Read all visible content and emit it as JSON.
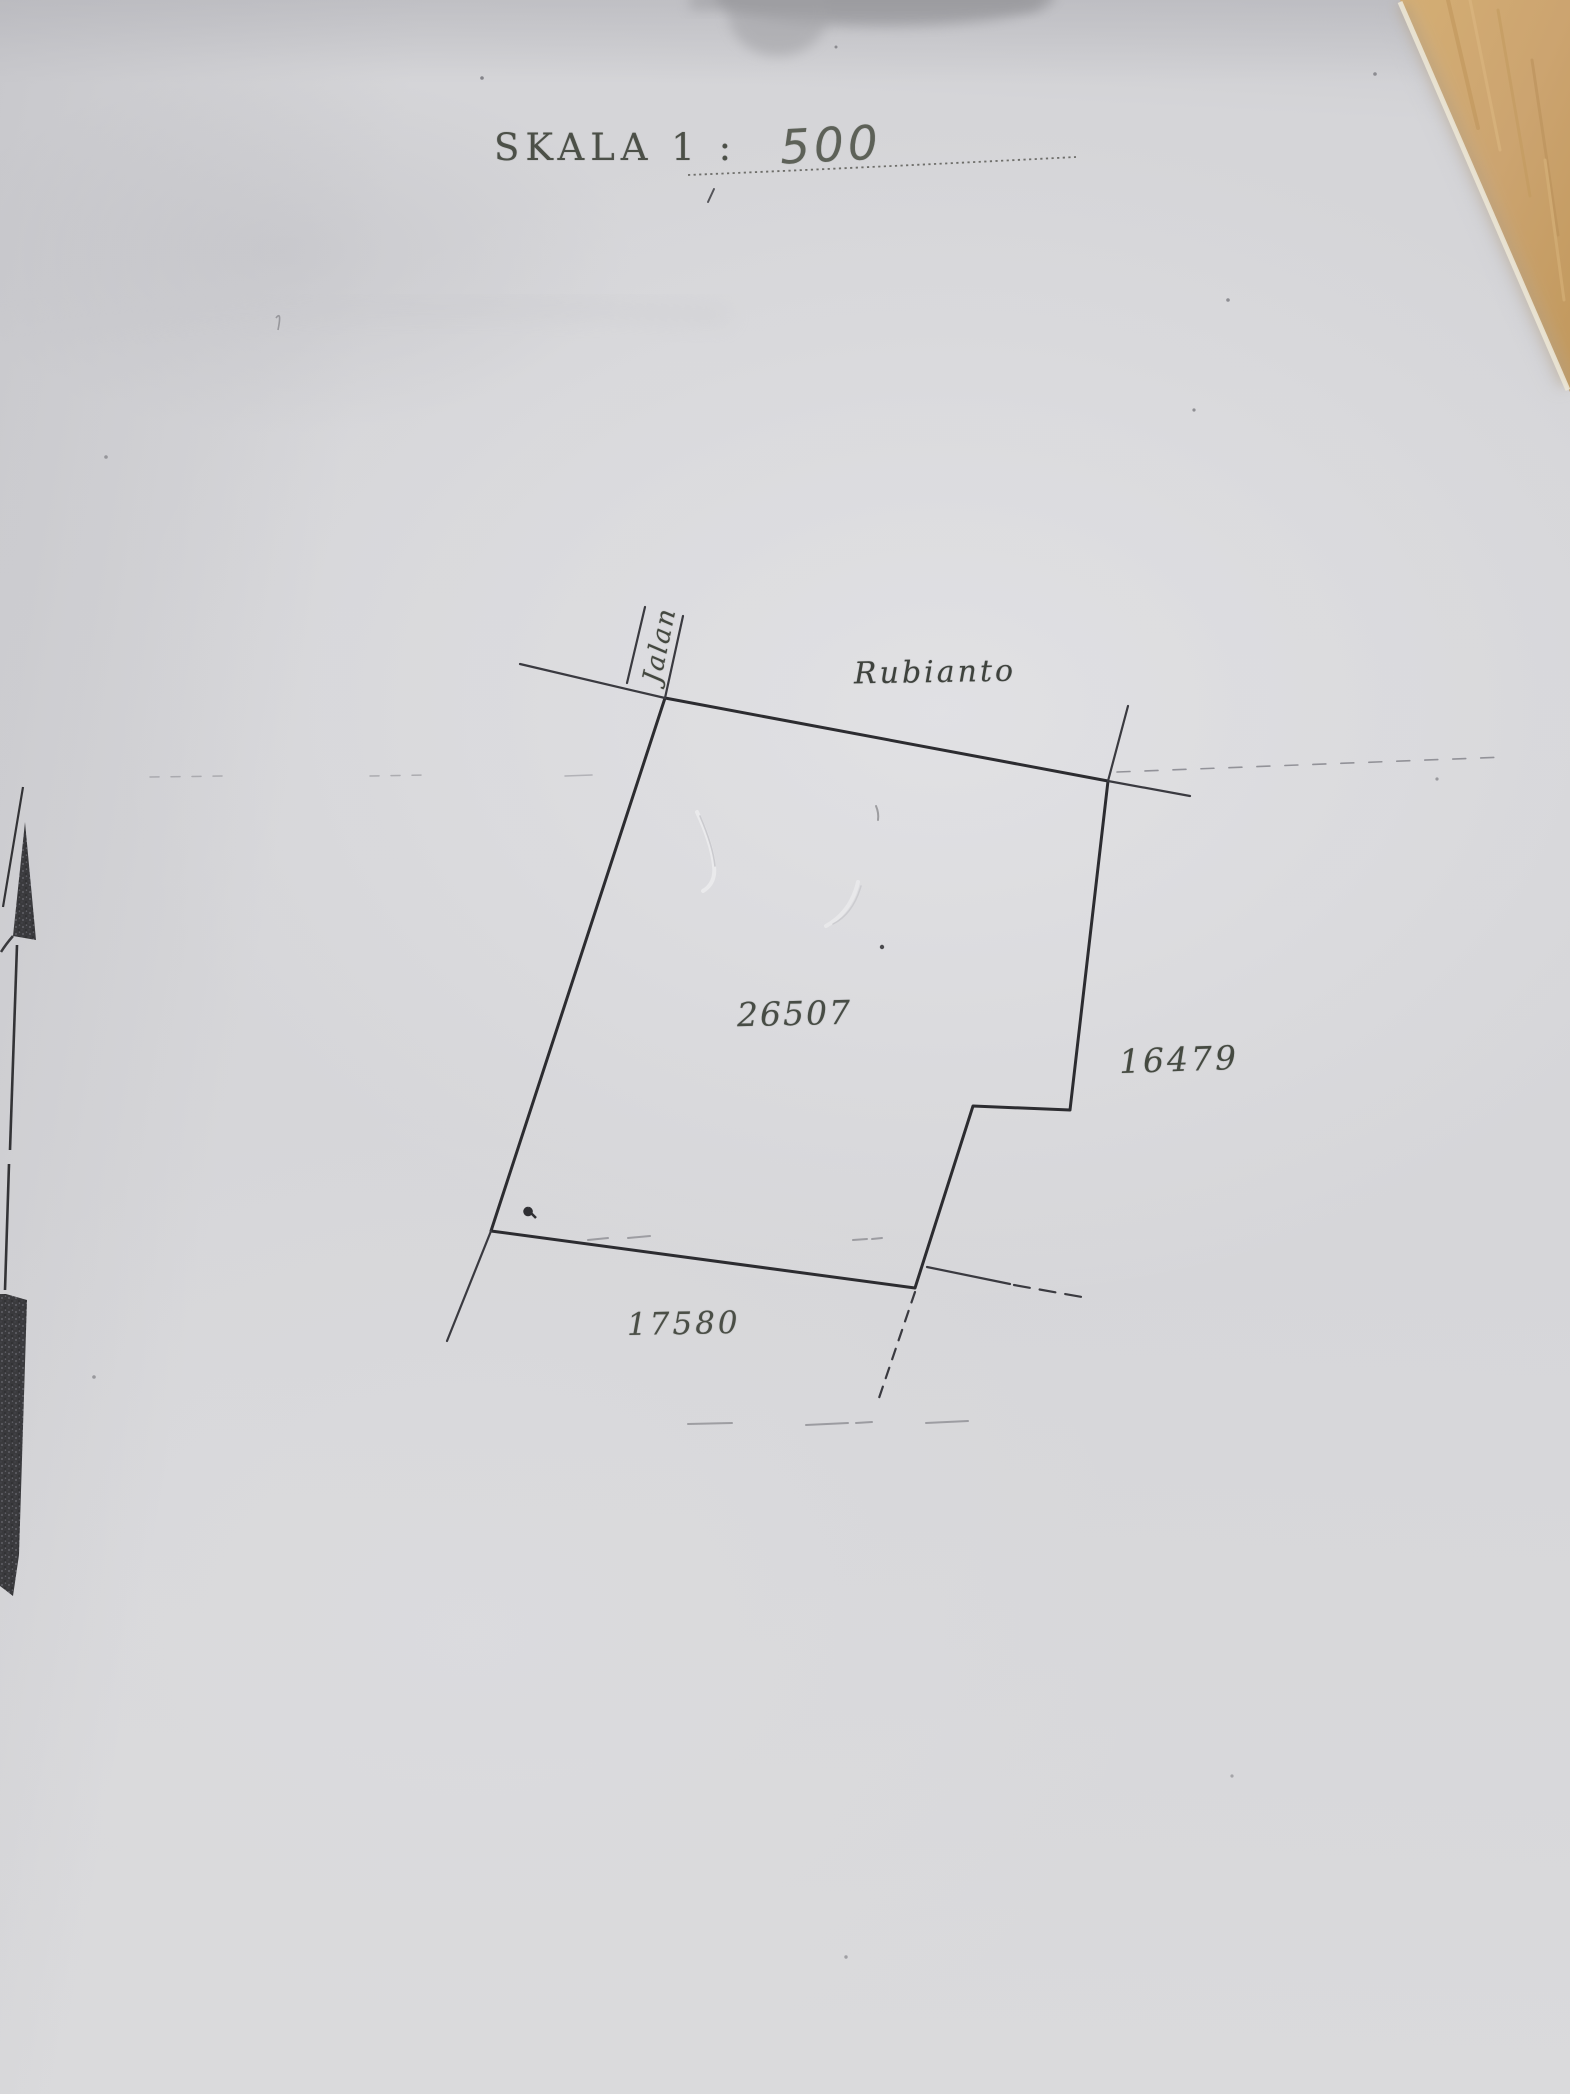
{
  "title": {
    "scale_label": "SKALA 1 :",
    "scale_value": "500"
  },
  "map": {
    "road": {
      "prefix": "Jalan",
      "name": "Rubianto"
    },
    "parcels": {
      "main": "26507",
      "east": "16479",
      "south": "17580"
    }
  },
  "icons": {
    "north_arrow": "north-arrow"
  },
  "colors": {
    "paper": "#d6d6d9",
    "ink": "#2d2d31",
    "label_ink": "#474c45",
    "wood_desk": "#cda76d"
  }
}
